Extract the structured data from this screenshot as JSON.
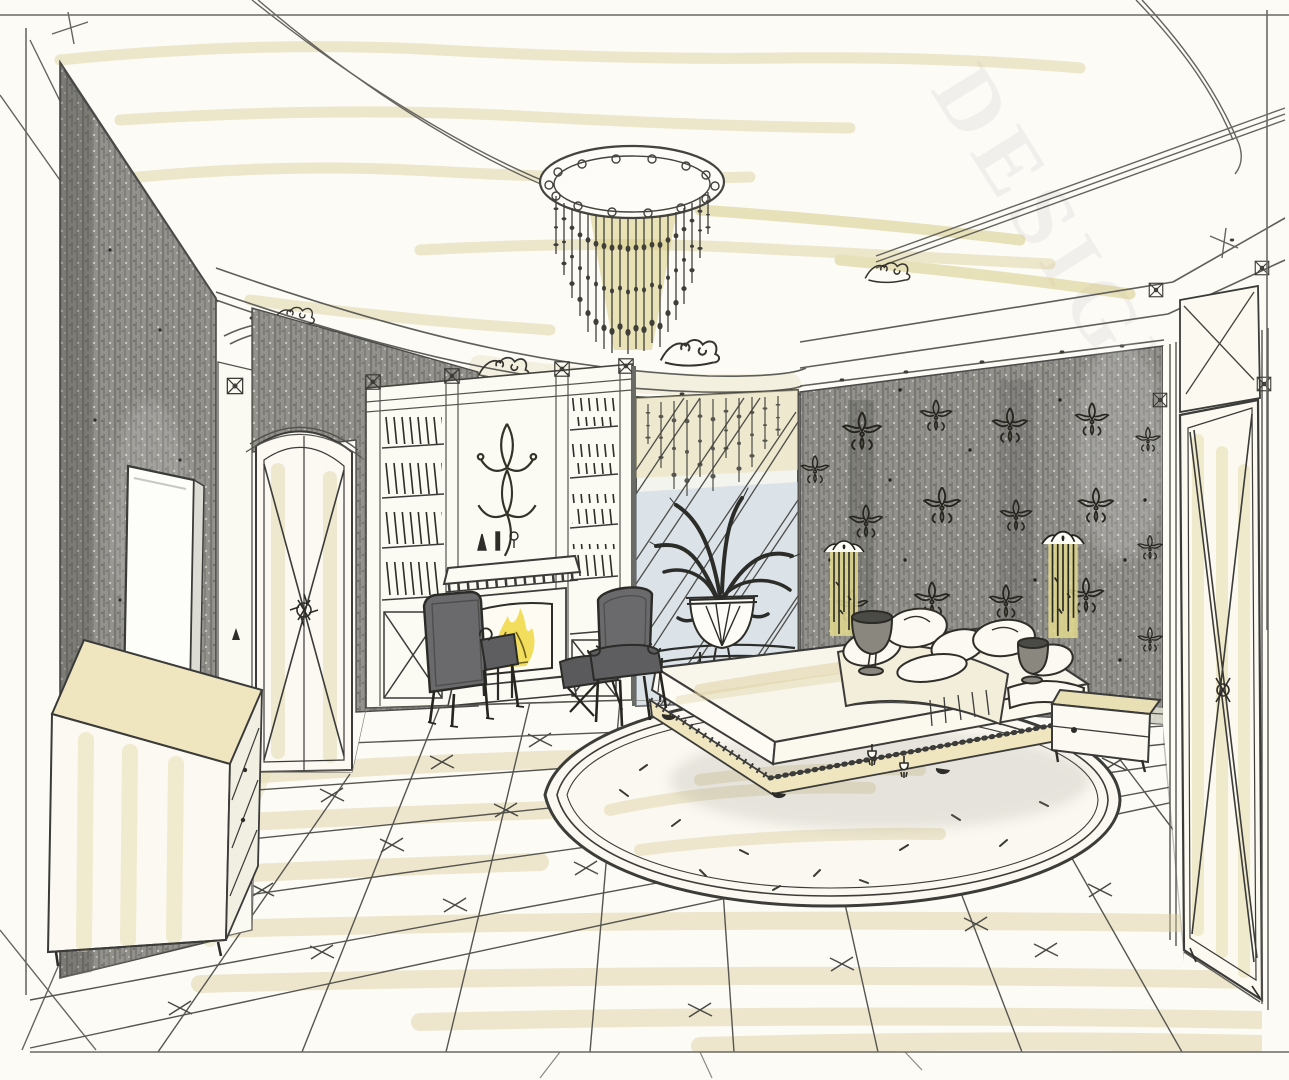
{
  "watermark": {
    "text": "DESIGN.R"
  },
  "palette": {
    "paper": "#fcfbf6",
    "ink": "#3c3b36",
    "pencil": "#6e6d68",
    "graphite_wall": "#93928d",
    "graphite_dark": "#4b4b47",
    "tan_marker": "#d9cb96",
    "olive_marker": "#cfc06e",
    "chandelier_wash": "#d6c977",
    "flame_yellow": "#f2da50",
    "mirror_blue": "#c7d4e3",
    "upholstery_gray": "#6a6a6c"
  },
  "scene": {
    "style": "hand-drawn pencil and marker interior sketch",
    "room": "classic bedroom with fireplace and crystal chandelier",
    "objects": [
      {
        "id": "chandelier",
        "label": "cascading crystal chandelier on oval ceiling medallion"
      },
      {
        "id": "cove-ceiling",
        "label": "coved ceiling with scroll cartouches"
      },
      {
        "id": "left-wall",
        "label": "dark textured accent wall"
      },
      {
        "id": "tv-panel",
        "label": "flat panel on left wall"
      },
      {
        "id": "dresser",
        "label": "long low dresser with marker-washed top"
      },
      {
        "id": "arched-door",
        "label": "arched door with X muntins and rosette"
      },
      {
        "id": "bookcase",
        "label": "built-in bookcase with hatched books"
      },
      {
        "id": "fireplace",
        "label": "classical mantel fireplace with burning fire"
      },
      {
        "id": "armchair-left",
        "label": "upholstered armchair seen from behind"
      },
      {
        "id": "armchair-right",
        "label": "upholstered armchair facing fireplace"
      },
      {
        "id": "ottoman",
        "label": "small upholstered bench with X legs"
      },
      {
        "id": "mirror-panel",
        "label": "diamond-lattice mirror wall reflecting chandelier"
      },
      {
        "id": "plant-urn",
        "label": "fluted half-round urn with plant on console"
      },
      {
        "id": "damask-wall",
        "label": "dark damask wallpaper wall"
      },
      {
        "id": "sconce",
        "label": "crystal-strand wall sconce"
      },
      {
        "id": "bed",
        "label": "low platform bed with pillow pile and fringed throw"
      },
      {
        "id": "nightstand",
        "label": "bedside chest with drawer"
      },
      {
        "id": "rug",
        "label": "large oval rug with concentric border"
      },
      {
        "id": "tile-floor",
        "label": "diagonal tile floor with cross accents"
      },
      {
        "id": "right-door",
        "label": "tall paneled door with X cross and rosette"
      }
    ]
  }
}
